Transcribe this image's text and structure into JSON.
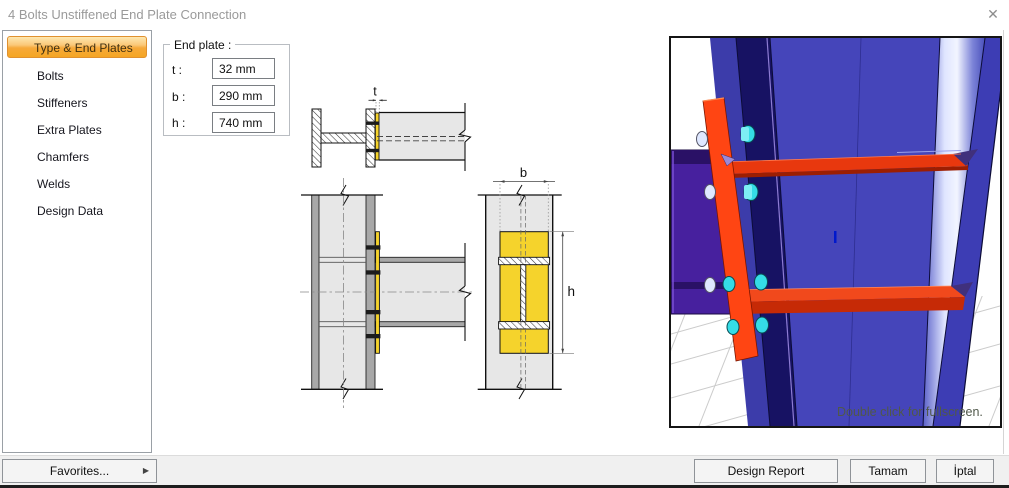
{
  "window": {
    "title": "4 Bolts Unstiffened End Plate Connection",
    "close_icon": "✕"
  },
  "sidebar": {
    "items": [
      {
        "label": "Type & End Plates",
        "selected": true
      },
      {
        "label": "Bolts",
        "selected": false
      },
      {
        "label": "Stiffeners",
        "selected": false
      },
      {
        "label": "Extra Plates",
        "selected": false
      },
      {
        "label": "Chamfers",
        "selected": false
      },
      {
        "label": "Welds",
        "selected": false
      },
      {
        "label": "Design Data",
        "selected": false
      }
    ]
  },
  "end_plate": {
    "group_label": "End plate :",
    "fields": [
      {
        "label": "t :",
        "value": "32 mm"
      },
      {
        "label": "b :",
        "value": "290 mm"
      },
      {
        "label": "h :",
        "value": "740 mm"
      }
    ]
  },
  "diagram": {
    "labels": {
      "t": "t",
      "b": "b",
      "h": "h"
    }
  },
  "viewport": {
    "hint": "Double click for fullscreen."
  },
  "footer": {
    "favorites": "Favorites...",
    "favorites_arrow": "▶",
    "design_report": "Design Report",
    "ok": "Tamam",
    "cancel": "İptal"
  },
  "colors": {
    "selected_item_top": "#fde8b0",
    "selected_item_bottom": "#f5a623",
    "selected_item_border": "#e0912f",
    "plate_yellow": "#f5d32c",
    "steel_gray": "#e7e7e7",
    "flange_gray": "#a8a8a8",
    "render_web_blue": "#4545ba",
    "render_flange_navy": "#171263",
    "render_column_purple": "#47209e",
    "render_endplate_orange": "#ff4513",
    "render_plate_red": "#e8380e",
    "bolt_cyan": "#35dce6"
  }
}
